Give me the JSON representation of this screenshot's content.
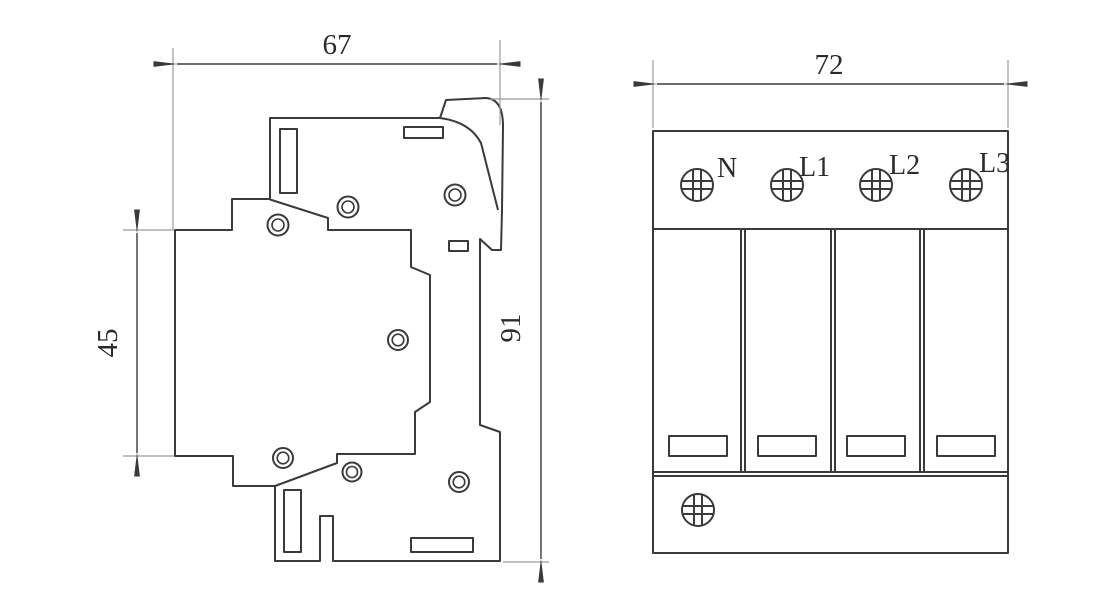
{
  "drawing": {
    "type": "dimensioned outline drawing of a 4-pole DIN-rail surge protective device",
    "colors": {
      "line": "#3a3a3a",
      "extension_line": "#9b9b9b",
      "text": "#2b2b2b",
      "background": "#ffffff"
    },
    "views": {
      "side": {
        "dim_width": "67",
        "dim_total_height": "91",
        "dim_rail_height": "45"
      },
      "front": {
        "dim_width": "72",
        "terminals": [
          "N",
          "L1",
          "L2",
          "L3"
        ]
      }
    }
  }
}
